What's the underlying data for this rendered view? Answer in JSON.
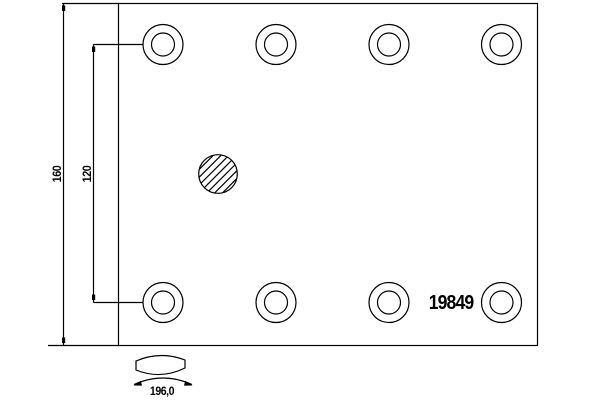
{
  "labels": {
    "part_number": "19849",
    "dim_total_height": "160",
    "dim_hole_spacing": "120",
    "dim_arc_length": "196,0"
  },
  "geometry": {
    "plate": {
      "x": 118.5,
      "y": 3.5,
      "width": 419,
      "height": 342
    },
    "holes": {
      "columns_x": [
        163,
        276,
        389,
        501.5
      ],
      "rows_y": [
        44.5,
        302.5
      ],
      "outer_r": 20,
      "inner_r": 11.5
    },
    "hatched_circle": {
      "cx": 218,
      "cy": 174,
      "r": 19.3,
      "hatch_spacing": 7.8,
      "hatch_count": 7
    }
  },
  "colors": {
    "line": "#000000",
    "background": "#ffffff",
    "text": "#000000"
  }
}
